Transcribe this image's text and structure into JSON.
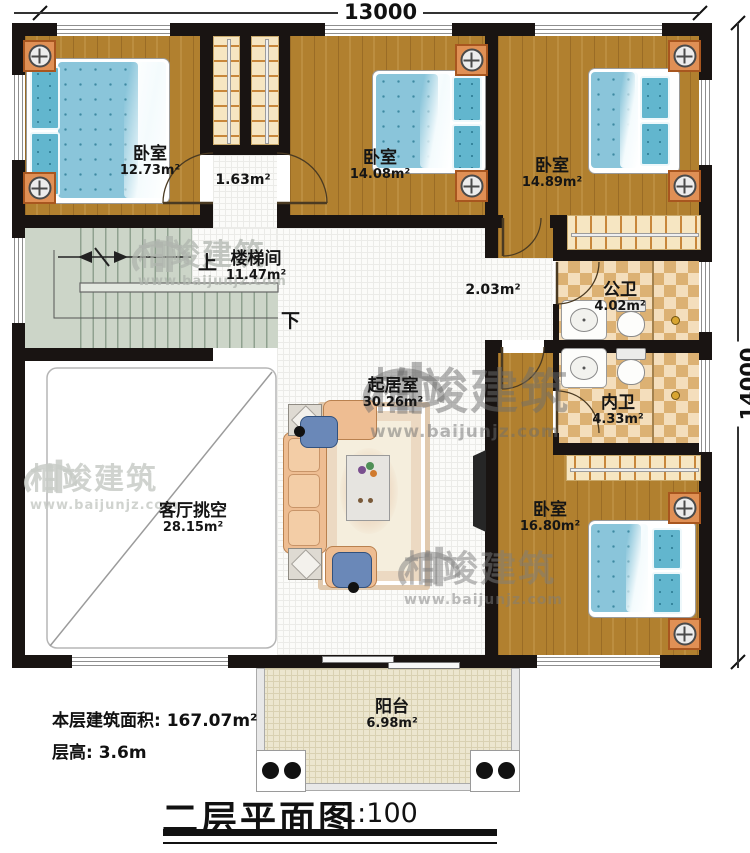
{
  "plan": {
    "title": "二层平面图",
    "scale": "1:100",
    "dimensions": {
      "top": "13000",
      "right": "14000"
    },
    "footer": {
      "floor_area_label": "本层建筑面积: 167.07m²",
      "floor_height_label": "层高: 3.6m"
    }
  },
  "rooms": [
    {
      "id": "bedroom-1",
      "name": "卧室",
      "area": "12.73m²"
    },
    {
      "id": "vestibule",
      "name": "",
      "area": "1.63m²"
    },
    {
      "id": "bedroom-2",
      "name": "卧室",
      "area": "14.08m²"
    },
    {
      "id": "bedroom-3",
      "name": "卧室",
      "area": "14.89m²"
    },
    {
      "id": "stairwell",
      "name": "楼梯间",
      "area": "11.47m²"
    },
    {
      "id": "hallway",
      "name": "",
      "area": "2.03m²"
    },
    {
      "id": "public-bathroom",
      "name": "公卫",
      "area": "4.02m²"
    },
    {
      "id": "private-bathroom",
      "name": "内卫",
      "area": "4.33m²"
    },
    {
      "id": "living-room",
      "name": "起居室",
      "area": "30.26m²"
    },
    {
      "id": "living-void",
      "name": "客厅挑空",
      "area": "28.15m²"
    },
    {
      "id": "bedroom-4",
      "name": "卧室",
      "area": "16.80m²"
    },
    {
      "id": "balcony",
      "name": "阳台",
      "area": "6.98m²"
    }
  ],
  "stairs": {
    "up": "上",
    "down": "下"
  },
  "watermark": {
    "brand": "柏竣建筑",
    "url": "www.baijunjz.com"
  },
  "colors": {
    "wall": "#191412",
    "wood_floor": "#b1802f",
    "bed_blue": "#8ac5da",
    "bath_tile": "#dcb173",
    "stair_green": "#ccd5c8",
    "balcony_floor": "#ece6cf",
    "sofa_peach": "#eebd92",
    "nightstand_orange": "#e09055"
  }
}
